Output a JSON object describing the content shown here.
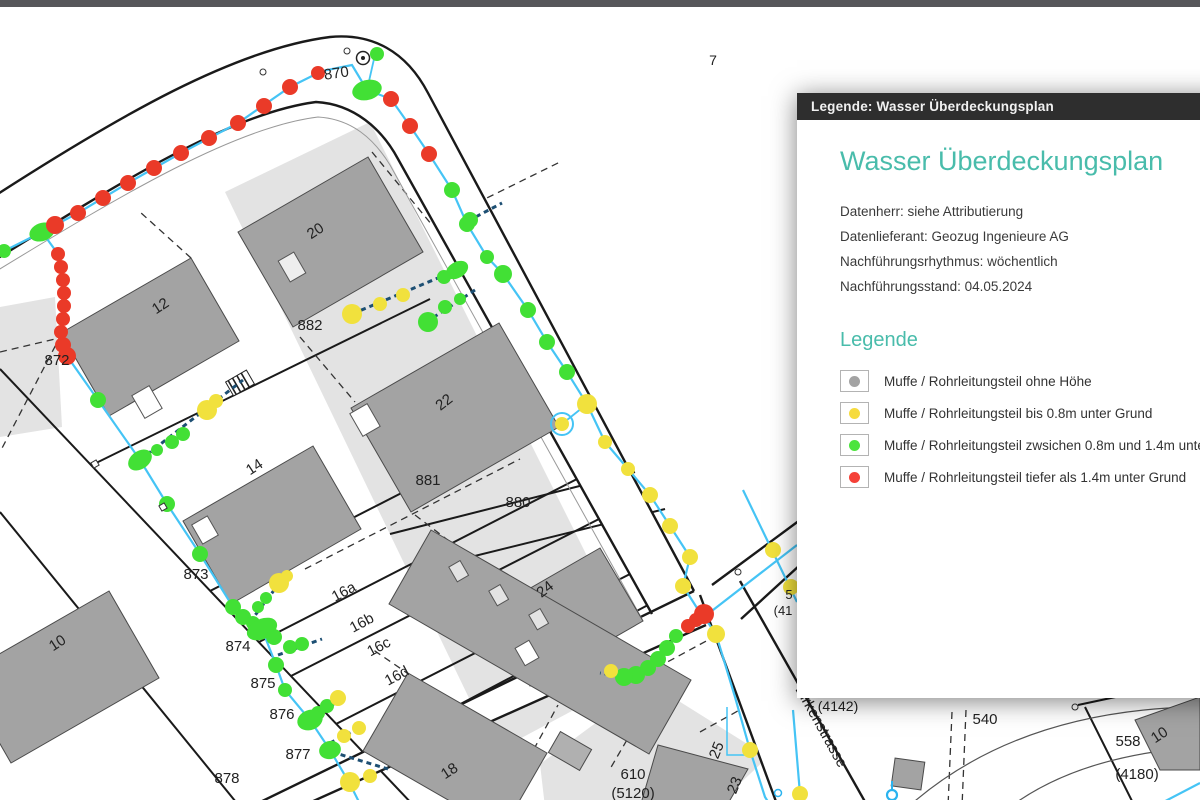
{
  "top_bar": {
    "color": "#57575a"
  },
  "panel": {
    "title_bar": "Legende: Wasser Überdeckungsplan",
    "heading": "Wasser Überdeckungsplan",
    "accent_color": "#49bcab",
    "meta_lines": [
      "Datenherr: siehe Attributierung",
      "Datenlieferant: Geozug Ingenieure AG",
      "Nachführungsrhythmus: wöchentlich",
      "Nachführungsstand: 04.05.2024"
    ],
    "legend_heading": "Legende",
    "items": [
      {
        "color": "#a3a3a3",
        "label": "Muffe / Rohrleitungsteil ohne Höhe"
      },
      {
        "color": "#f6db3e",
        "label": "Muffe / Rohrleitungsteil bis 0.8m unter Grund"
      },
      {
        "color": "#4ce43e",
        "label": "Muffe / Rohrleitungsteil zwsichen 0.8m und 1.4m unter Grund"
      },
      {
        "color": "#f54138",
        "label": "Muffe / Rohrleitungsteil tiefer als 1.4m unter Grund"
      }
    ]
  },
  "map": {
    "colors": {
      "pipe": "#45c4f5",
      "pipe_dashed": "#1d4f73",
      "red": "#ea3a28",
      "green": "#42e035",
      "yellow": "#f1e13d",
      "gray": "#a3a3a3"
    },
    "labels": [
      {
        "t": "870",
        "x": 337,
        "y": 71,
        "rot": -8
      },
      {
        "t": "7",
        "x": 713,
        "y": 58,
        "size": 14
      },
      {
        "t": "872",
        "x": 57,
        "y": 358
      },
      {
        "t": "882",
        "x": 310,
        "y": 323
      },
      {
        "t": "12",
        "x": 163,
        "y": 303,
        "rot": -33
      },
      {
        "t": "20",
        "x": 318,
        "y": 228,
        "rot": -33
      },
      {
        "t": "22",
        "x": 447,
        "y": 399,
        "rot": -38
      },
      {
        "t": "14",
        "x": 257,
        "y": 464,
        "rot": -33
      },
      {
        "t": "881",
        "x": 428,
        "y": 478
      },
      {
        "t": "880",
        "x": 518,
        "y": 500
      },
      {
        "t": "873",
        "x": 196,
        "y": 572
      },
      {
        "t": "874",
        "x": 238,
        "y": 644
      },
      {
        "t": "875",
        "x": 263,
        "y": 681
      },
      {
        "t": "876",
        "x": 282,
        "y": 712
      },
      {
        "t": "877",
        "x": 298,
        "y": 752
      },
      {
        "t": "878",
        "x": 227,
        "y": 776
      },
      {
        "t": "10",
        "x": 60,
        "y": 640,
        "rot": -33
      },
      {
        "t": "16a",
        "x": 346,
        "y": 589,
        "rot": -28
      },
      {
        "t": "16b",
        "x": 364,
        "y": 620,
        "rot": -28
      },
      {
        "t": "16c",
        "x": 381,
        "y": 644,
        "rot": -28
      },
      {
        "t": "16d",
        "x": 399,
        "y": 673,
        "rot": -28
      },
      {
        "t": "18",
        "x": 452,
        "y": 768,
        "rot": -33
      },
      {
        "t": "24",
        "x": 548,
        "y": 586,
        "rot": -38
      },
      {
        "t": "610",
        "x": 633,
        "y": 772
      },
      {
        "t": "(5120)",
        "x": 633,
        "y": 791
      },
      {
        "t": "25",
        "x": 721,
        "y": 745,
        "rot": -68
      },
      {
        "t": "23",
        "x": 739,
        "y": 780,
        "rot": -68
      },
      {
        "t": "(4142)",
        "x": 838,
        "y": 704,
        "size": 14
      },
      {
        "t": "540",
        "x": 985,
        "y": 717
      },
      {
        "t": "558",
        "x": 1128,
        "y": 739
      },
      {
        "t": "10",
        "x": 1162,
        "y": 732,
        "rot": -33
      },
      {
        "t": "(4180)",
        "x": 1137,
        "y": 772
      },
      {
        "t": "5",
        "x": 789,
        "y": 592,
        "size": 13
      },
      {
        "t": "(41",
        "x": 783,
        "y": 608,
        "size": 13
      },
      {
        "t": "Birkenstrasse",
        "x": 795,
        "y": 682,
        "rot": 61,
        "anchor": "s",
        "size": 15
      }
    ],
    "pipes": [
      {
        "pts": [
          [
            -5,
            252
          ],
          [
            4,
            244
          ],
          [
            42,
            225
          ],
          [
            78,
            206
          ],
          [
            128,
            176
          ],
          [
            181,
            146
          ],
          [
            238,
            116
          ],
          [
            290,
            80
          ],
          [
            322,
            64
          ],
          [
            352,
            58
          ],
          [
            367,
            83
          ],
          [
            391,
            92
          ],
          [
            410,
            119
          ],
          [
            429,
            147
          ],
          [
            452,
            183
          ],
          [
            467,
            217
          ],
          [
            487,
            250
          ],
          [
            503,
            267
          ],
          [
            528,
            303
          ],
          [
            547,
            335
          ],
          [
            567,
            365
          ],
          [
            587,
            397
          ],
          [
            605,
            435
          ],
          [
            628,
            462
          ],
          [
            650,
            488
          ],
          [
            670,
            519
          ],
          [
            690,
            550
          ],
          [
            683,
            579
          ],
          [
            697,
            601
          ],
          [
            704,
            610
          ],
          [
            716,
            627
          ],
          [
            735,
            690
          ],
          [
            750,
            743
          ],
          [
            765,
            790
          ],
          [
            772,
            801
          ]
        ]
      },
      {
        "pts": [
          [
            42,
            225
          ],
          [
            58,
            247
          ],
          [
            63,
            273
          ],
          [
            64,
            299
          ],
          [
            62,
            325
          ],
          [
            67,
            349
          ],
          [
            98,
            393
          ],
          [
            140,
            453
          ],
          [
            167,
            497
          ],
          [
            200,
            547
          ],
          [
            233,
            600
          ],
          [
            262,
            622
          ],
          [
            276,
            658
          ],
          [
            285,
            683
          ],
          [
            310,
            713
          ],
          [
            330,
            743
          ],
          [
            350,
            777
          ],
          [
            362,
            801
          ]
        ]
      },
      {
        "pts": [
          [
            367,
            83
          ],
          [
            374,
            52
          ]
        ],
        "w": 1.8
      },
      {
        "pts": [
          [
            587,
            397
          ],
          [
            562,
            417
          ]
        ],
        "w": 1.8
      },
      {
        "pts": [
          [
            704,
            610
          ],
          [
            797,
            538
          ]
        ]
      },
      {
        "pts": [
          [
            743,
            483
          ],
          [
            797,
            595
          ]
        ]
      },
      {
        "pts": [
          [
            727,
            700
          ],
          [
            727,
            748
          ],
          [
            753,
            748
          ]
        ],
        "w": 1.5
      },
      {
        "pts": [
          [
            793,
            703
          ],
          [
            800,
            787
          ],
          [
            804,
            801
          ]
        ]
      },
      {
        "pts": [
          [
            1152,
            801
          ],
          [
            1200,
            776
          ]
        ]
      }
    ],
    "dashed_pipes": [
      {
        "pts": [
          [
            457,
            263
          ],
          [
            352,
            307
          ]
        ]
      },
      {
        "pts": [
          [
            475,
            283
          ],
          [
            425,
            316
          ]
        ]
      },
      {
        "pts": [
          [
            140,
            453
          ],
          [
            243,
            373
          ]
        ]
      },
      {
        "pts": [
          [
            250,
            615
          ],
          [
            281,
            574
          ]
        ]
      },
      {
        "pts": [
          [
            278,
            648
          ],
          [
            322,
            632
          ]
        ]
      },
      {
        "pts": [
          [
            312,
            715
          ],
          [
            342,
            690
          ]
        ]
      },
      {
        "pts": [
          [
            332,
            745
          ],
          [
            388,
            762
          ]
        ]
      },
      {
        "pts": [
          [
            330,
            736
          ],
          [
            362,
            720
          ]
        ]
      },
      {
        "pts": [
          [
            468,
            214
          ],
          [
            502,
            196
          ]
        ]
      },
      {
        "pts": [
          [
            704,
            610
          ],
          [
            676,
            629
          ],
          [
            658,
            652
          ],
          [
            636,
            668
          ],
          [
            624,
            670
          ],
          [
            600,
            666
          ]
        ]
      }
    ],
    "dots": [
      [
        4,
        244,
        7,
        "g"
      ],
      [
        42,
        225,
        9,
        "g",
        13,
        9,
        -20
      ],
      [
        55,
        218,
        9,
        "r"
      ],
      [
        78,
        206,
        8,
        "r"
      ],
      [
        103,
        191,
        8,
        "r"
      ],
      [
        128,
        176,
        8,
        "r"
      ],
      [
        154,
        161,
        8,
        "r"
      ],
      [
        181,
        146,
        8,
        "r"
      ],
      [
        209,
        131,
        8,
        "r"
      ],
      [
        238,
        116,
        8,
        "r"
      ],
      [
        264,
        99,
        8,
        "r"
      ],
      [
        290,
        80,
        8,
        "r"
      ],
      [
        318,
        66,
        7,
        "r"
      ],
      [
        377,
        47,
        7,
        "g"
      ],
      [
        367,
        83,
        10,
        "g",
        15,
        10,
        -15
      ],
      [
        391,
        92,
        8,
        "r"
      ],
      [
        410,
        119,
        8,
        "r"
      ],
      [
        429,
        147,
        8,
        "r"
      ],
      [
        58,
        247,
        7,
        "r"
      ],
      [
        61,
        260,
        7,
        "r"
      ],
      [
        63,
        273,
        7,
        "r"
      ],
      [
        64,
        286,
        7,
        "r"
      ],
      [
        64,
        299,
        7,
        "r"
      ],
      [
        63,
        312,
        7,
        "r"
      ],
      [
        61,
        325,
        7,
        "r"
      ],
      [
        63,
        338,
        8,
        "r"
      ],
      [
        67,
        349,
        9,
        "r"
      ],
      [
        452,
        183,
        8,
        "g"
      ],
      [
        467,
        217,
        8,
        "g"
      ],
      [
        487,
        250,
        7,
        "g"
      ],
      [
        503,
        267,
        9,
        "g"
      ],
      [
        528,
        303,
        8,
        "g"
      ],
      [
        547,
        335,
        8,
        "g"
      ],
      [
        567,
        365,
        8,
        "g"
      ],
      [
        587,
        397,
        10,
        "y"
      ],
      [
        562,
        417,
        7,
        "yr"
      ],
      [
        605,
        435,
        7,
        "y"
      ],
      [
        628,
        462,
        7,
        "y"
      ],
      [
        650,
        488,
        8,
        "y"
      ],
      [
        670,
        519,
        8,
        "y"
      ],
      [
        690,
        550,
        8,
        "y"
      ],
      [
        683,
        579,
        8,
        "y"
      ],
      [
        688,
        619,
        7,
        "r"
      ],
      [
        696,
        613,
        7,
        "r"
      ],
      [
        704,
        607,
        10,
        "r"
      ],
      [
        676,
        629,
        7,
        "g"
      ],
      [
        667,
        641,
        8,
        "g"
      ],
      [
        658,
        652,
        8,
        "g"
      ],
      [
        648,
        661,
        8,
        "g"
      ],
      [
        636,
        668,
        9,
        "g"
      ],
      [
        624,
        670,
        9,
        "g"
      ],
      [
        611,
        664,
        7,
        "y"
      ],
      [
        716,
        627,
        9,
        "y"
      ],
      [
        750,
        743,
        8,
        "y"
      ],
      [
        800,
        787,
        8,
        "y"
      ],
      [
        773,
        543,
        8,
        "y"
      ],
      [
        791,
        580,
        8,
        "y"
      ],
      [
        98,
        393,
        8,
        "g"
      ],
      [
        140,
        453,
        9,
        "g",
        13,
        9,
        -35
      ],
      [
        167,
        497,
        8,
        "g"
      ],
      [
        200,
        547,
        8,
        "g"
      ],
      [
        233,
        600,
        8,
        "g"
      ],
      [
        243,
        610,
        8,
        "g"
      ],
      [
        253,
        616,
        7,
        "g"
      ],
      [
        262,
        622,
        10,
        "g",
        16,
        10,
        -25
      ],
      [
        274,
        630,
        8,
        "g"
      ],
      [
        290,
        640,
        7,
        "g"
      ],
      [
        302,
        637,
        7,
        "g"
      ],
      [
        276,
        658,
        8,
        "g"
      ],
      [
        285,
        683,
        7,
        "g"
      ],
      [
        318,
        706,
        7,
        "g"
      ],
      [
        327,
        699,
        7,
        "g"
      ],
      [
        310,
        713,
        10,
        "g",
        13,
        10,
        -20
      ],
      [
        338,
        691,
        8,
        "y"
      ],
      [
        344,
        729,
        7,
        "y"
      ],
      [
        359,
        721,
        7,
        "y"
      ],
      [
        330,
        743,
        9,
        "g",
        11,
        9,
        -15
      ],
      [
        350,
        775,
        10,
        "y"
      ],
      [
        370,
        769,
        7,
        "y"
      ],
      [
        157,
        443,
        6,
        "g"
      ],
      [
        172,
        435,
        7,
        "g"
      ],
      [
        183,
        427,
        7,
        "g"
      ],
      [
        207,
        403,
        10,
        "y"
      ],
      [
        216,
        394,
        7,
        "y"
      ],
      [
        444,
        270,
        7,
        "g"
      ],
      [
        457,
        263,
        9,
        "g",
        12,
        8,
        -30
      ],
      [
        403,
        288,
        7,
        "y"
      ],
      [
        380,
        297,
        7,
        "y"
      ],
      [
        352,
        307,
        10,
        "y"
      ],
      [
        460,
        292,
        6,
        "g"
      ],
      [
        445,
        300,
        7,
        "g"
      ],
      [
        428,
        315,
        10,
        "g"
      ],
      [
        470,
        213,
        8,
        "g"
      ],
      [
        258,
        600,
        6,
        "g"
      ],
      [
        266,
        591,
        6,
        "g"
      ],
      [
        279,
        576,
        10,
        "y"
      ],
      [
        287,
        569,
        6,
        "y"
      ]
    ]
  }
}
